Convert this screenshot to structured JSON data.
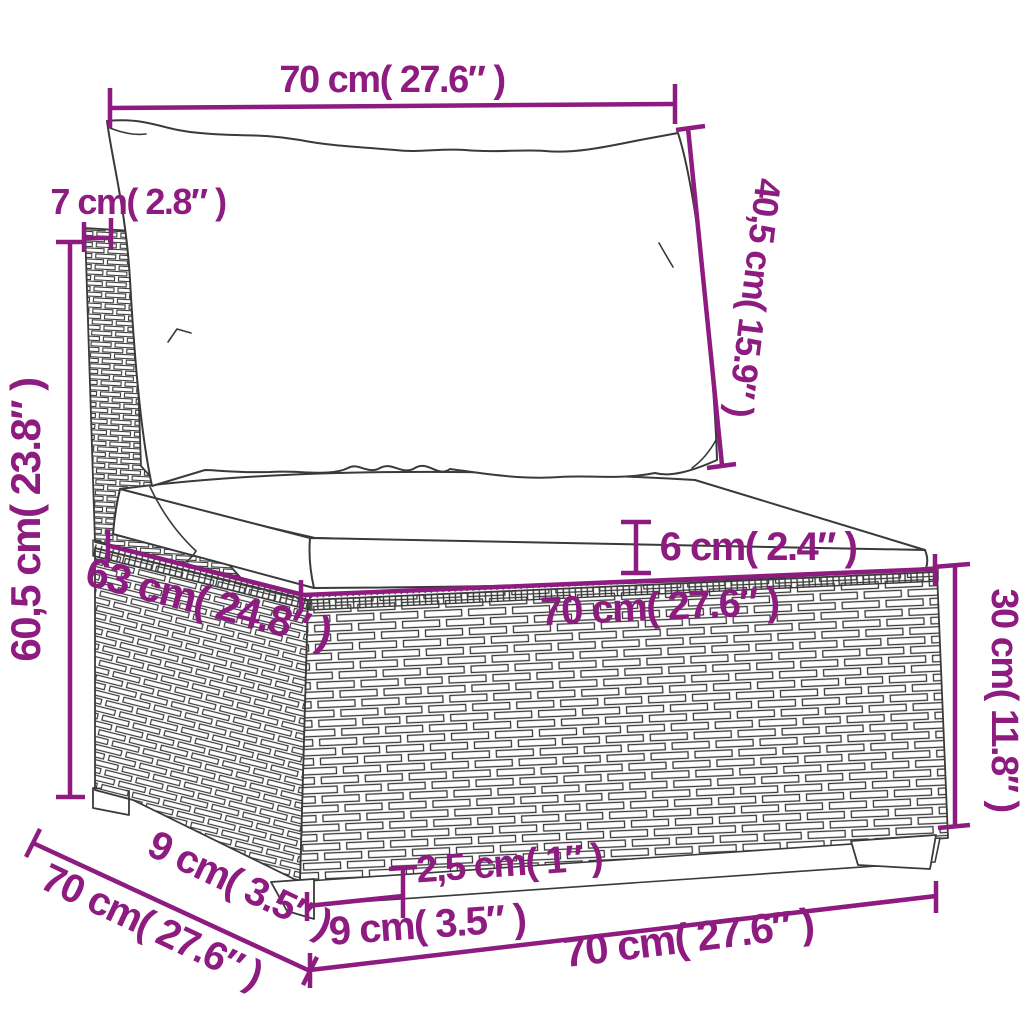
{
  "diagram_type": "furniture-dimension-line-drawing",
  "subject": "rattan-sectional-middle-sofa-with-cushions",
  "colors": {
    "dimension_annotation": "#8d1b80",
    "line_art": "#3a3a3a",
    "background": "#ffffff"
  },
  "dimensions": {
    "back_cushion_width": "70 cm( 27.6″ )",
    "back_panel_thickness": "7 cm( 2.8″ )",
    "back_cushion_height": "40,5 cm( 15.9″ )",
    "overall_height": "60,5 cm( 23.8″ )",
    "seat_cushion_thickness": "6 cm( 2.4″ )",
    "seat_top_depth": "63 cm( 24.8″ )",
    "seat_front_width": "70 cm( 27.6″ )",
    "base_height": "30 cm( 11.8″ )",
    "side_foot_inset": "9 cm( 3.5″ )",
    "side_depth": "70 cm( 27.6″ )",
    "plinth_height": "2,5 cm( 1″ )",
    "front_foot_inset": "9 cm( 3.5″ )",
    "base_front_width": "70 cm( 27.6″ )"
  }
}
